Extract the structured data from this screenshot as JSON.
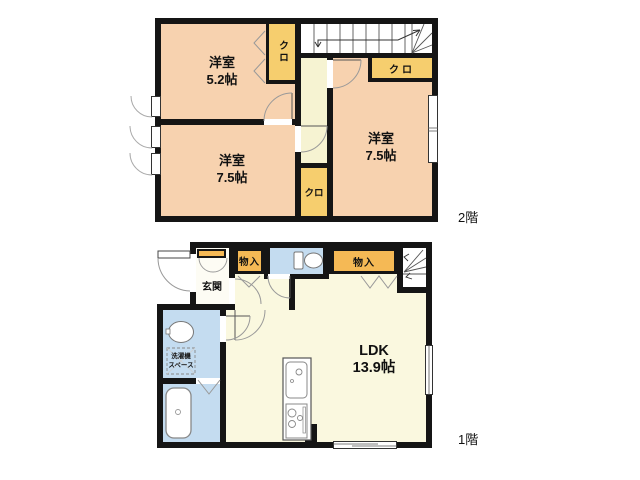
{
  "document": {
    "type": "floor-plan"
  },
  "colors": {
    "wall": "#151515",
    "room-peach": "#F7D2AF",
    "closet-yellow": "#F6CE6E",
    "storage-orange": "#F5B955",
    "hall-cream": "#F6F3D2",
    "ldk-cream": "#FAF8DF",
    "wet-blue": "#C4DCF0",
    "genkan-white": "#FDFCF4"
  },
  "floor2": {
    "floor_label": "2階",
    "room_top_left": {
      "label": "洋室",
      "size": "5.2帖"
    },
    "room_bottom_left": {
      "label": "洋室",
      "size": "7.5帖"
    },
    "room_right": {
      "label": "洋室",
      "size": "7.5帖"
    },
    "closet_top": "クロ",
    "closet_right": "クロ",
    "closet_bottom": "クロ"
  },
  "floor1": {
    "floor_label": "1階",
    "genkan": "玄関",
    "storage_left": "物入",
    "storage_right": "物入",
    "ldk": {
      "label": "LDK",
      "size": "13.9帖"
    },
    "laundry": {
      "line1": "洗濯機",
      "line2": "スペース"
    }
  }
}
